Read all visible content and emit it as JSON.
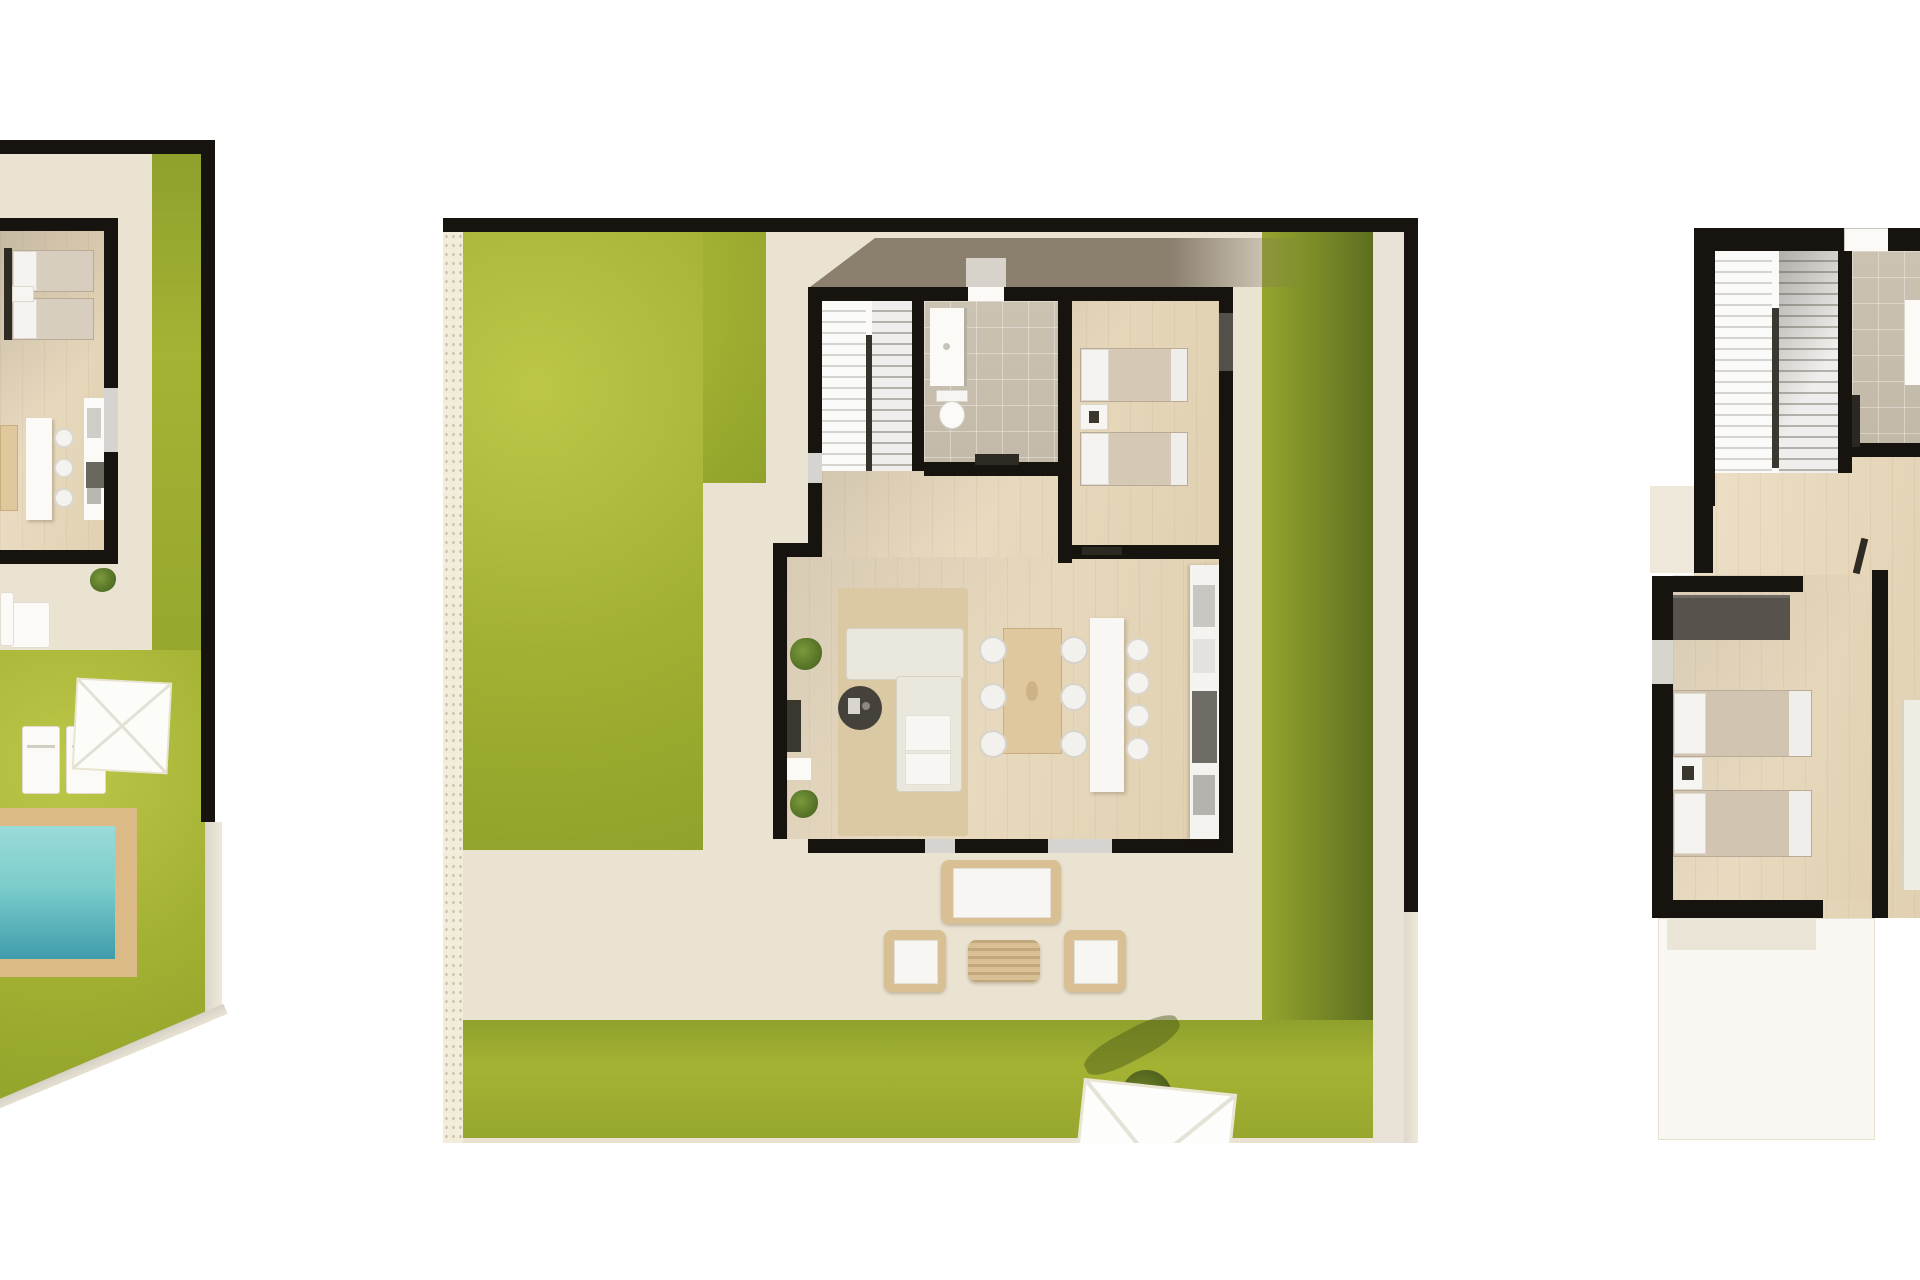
{
  "page": {
    "background": "#ffffff",
    "kind": "architectural top-down 3D floor plan renderings",
    "plan_count": 3,
    "visible_text": "none"
  },
  "colors": {
    "wall": "#17130e",
    "lawn": "#a2b032",
    "lawn_shadow": "#5d6f20",
    "terrace_ground": "#eae3d2",
    "gravel_path": "#f2ecdb",
    "wood_floor": "#e6d7ba",
    "tile_floor": "#c6bdac",
    "pool_water_shallow": "#94d8d5",
    "pool_water_deep": "#3f9cab",
    "pool_deck": "#dcba88",
    "rattan": "#d8bf94",
    "cushion_white": "#f7f6f2",
    "sofa_cream": "#eae7dc",
    "rug": "#dbc9a4",
    "porch_shadow": "#8f8372",
    "bed_blanket": "#d3c6b2",
    "wardrobe": "#57524c",
    "dining_table_wood": "#e0c89e",
    "dark_furniture": "#45423c"
  },
  "plans": [
    {
      "name": "ground-floor-plot-left-partial",
      "description": "Left villa plot, cropped by image edge: bedroom with two twin beds, kitchen with island and three stools, lawn strip, garden lawn, square parasol, two sun loungers, rectangular swimming pool with deck",
      "rooms": [
        "bedroom",
        "kitchen"
      ],
      "garden_items": [
        "lawn",
        "terrace",
        "parasol",
        "sun-lounger",
        "sun-lounger",
        "pool"
      ],
      "bed_count": 2,
      "stool_count": 3
    },
    {
      "name": "ground-floor-plot-main",
      "description": "Main villa ground floor plot: entrance porch with cast shadow, staircase, bathroom with shower and toilet, twin bedroom, kitchen with wall counter, island and four stools, dining table with six chairs, living room with L-shaped sofa, round coffee table, TV unit and plants, surrounding lawn, gravel path edge, terrace with rattan lounge set (sofa, two armchairs, coffee table), square parasol and tree at bottom right",
      "rooms": [
        "staircase",
        "bathroom",
        "bedroom",
        "kitchen",
        "dining-area",
        "living-room"
      ],
      "garden_items": [
        "lawn-left",
        "lawn-right",
        "lawn-bottom",
        "gravel-strip",
        "terrace",
        "rattan-sofa",
        "rattan-armchair",
        "rattan-armchair",
        "rattan-table",
        "parasol",
        "tree"
      ],
      "bed_count": 2,
      "dining_chair_count": 6,
      "stool_count": 4
    },
    {
      "name": "first-floor-plan-right-partial",
      "description": "Upper floor plan, cropped by image edge: U-shaped staircase, tiled bathroom, bedroom with wardrobe, two twin beds and nightstand, adjacent room with partial bed, lower terrace",
      "rooms": [
        "staircase",
        "bathroom",
        "bedroom",
        "hall"
      ],
      "furniture": [
        "wardrobe",
        "twin-bed",
        "twin-bed",
        "nightstand",
        "partial-bed"
      ],
      "bed_count": 2
    }
  ]
}
